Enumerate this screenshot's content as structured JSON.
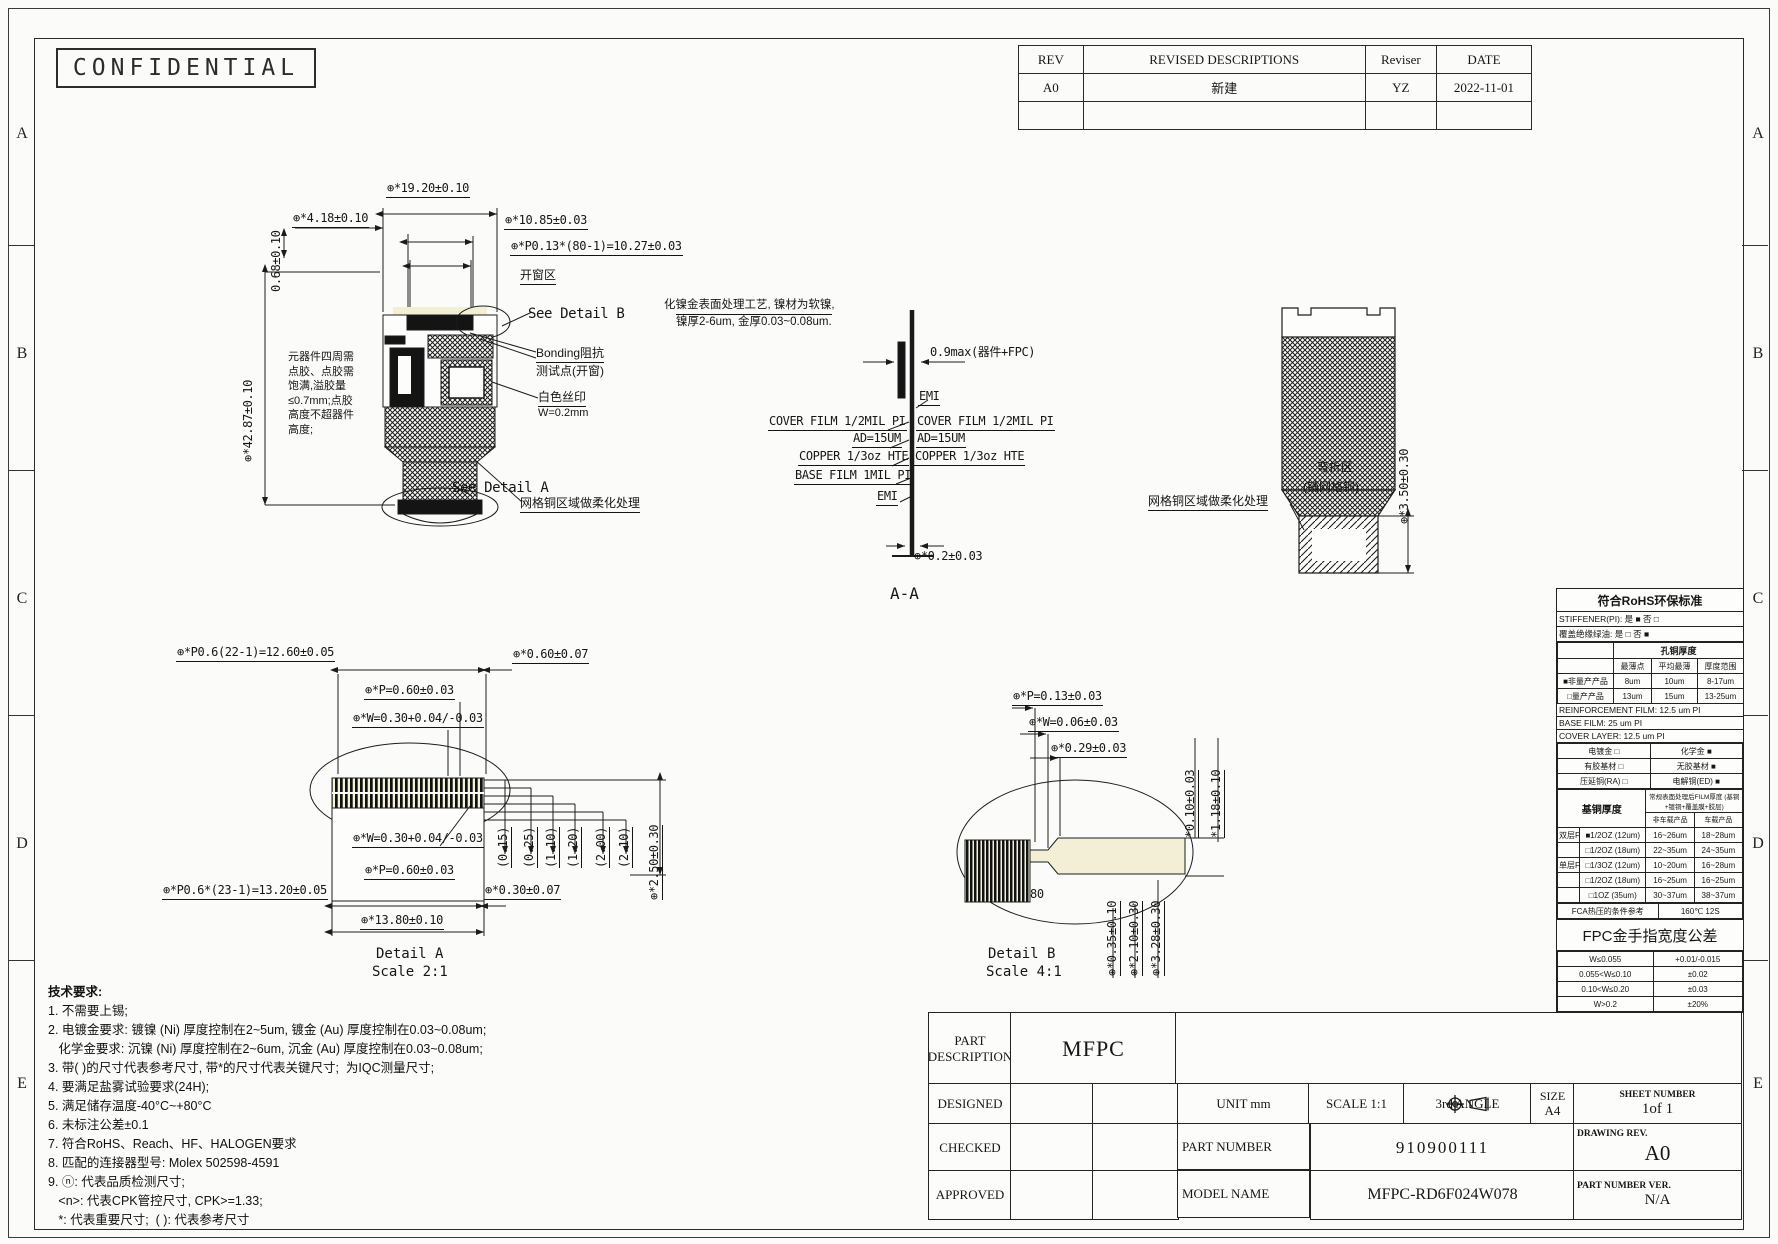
{
  "sheet": {
    "stamp": "CONFIDENTIAL",
    "zones": [
      "A",
      "B",
      "C",
      "D",
      "E"
    ]
  },
  "revision_table": {
    "headers": [
      "REV",
      "REVISED DESCRIPTIONS",
      "Reviser",
      "DATE"
    ],
    "row": [
      "A0",
      "新建",
      "YZ",
      "2022-11-01"
    ]
  },
  "plan_view": {
    "dims": {
      "width": "⊕*19.20±0.10",
      "offset": "⊕*4.18±0.10",
      "edge": "0.68±0.10",
      "finger": "⊕*10.85±0.03",
      "pitch": "⊕*P0.13*(80-1)=10.27±0.03",
      "length": "⊕*42.87±0.10"
    },
    "labels": {
      "window": "开窗区",
      "see_detail_b": "See Detail B",
      "bonding1": "Bonding阻抗",
      "bonding2": "测试点(开窗)",
      "silk1": "白色丝印",
      "silk2": "W=0.2mm",
      "mesh": "网格铜区域做柔化处理",
      "see_detail_a": "See Detail A"
    },
    "glue_note": [
      "元器件四周需",
      "点胶、点胶需",
      "饱满,溢胶量",
      "≤0.7mm;点胶",
      "高度不超器件",
      "高度;"
    ]
  },
  "section_view": {
    "caption": "A-A",
    "note1": "化镍金表面处理工艺, 镍材为软镍,",
    "note2": "镍厚2-6um, 金厚0.03~0.08um.",
    "dim_max": "0.9max(器件+FPC)",
    "dim_thickness": "⊕*0.2±0.03",
    "layers": {
      "emi_r": "EMI",
      "cover_l": "COVER FILM 1/2MIL PI",
      "cover_r": "COVER FILM 1/2MIL PI",
      "ad_l": "AD=15UM",
      "ad_r": "AD=15UM",
      "cu_l": "COPPER 1/3oz HTE",
      "cu_r": "COPPER 1/3oz HTE",
      "base_l": "BASE FILM 1MIL PI",
      "emi_l": "EMI"
    }
  },
  "bend_view": {
    "mesh": "网格铜区域做柔化处理",
    "zone1": "弯折区",
    "zone2": "(铺网格铜)",
    "dim": "⊕*3.50±0.30"
  },
  "detail_a": {
    "caption": "Detail A",
    "scale": "Scale 2:1",
    "dims": {
      "pitch_total_top": "⊕*P0.6(22-1)=12.60±0.05",
      "end_width": "⊕*0.60±0.07",
      "pitch_top": "⊕*P=0.60±0.03",
      "width_top": "⊕*W=0.30+0.04/-0.03",
      "width_in": "⊕*W=0.30+0.04/-0.03",
      "pitch_in": "⊕*P=0.60±0.03",
      "pitch_total_bottom": "⊕*P0.6*(23-1)=13.20±0.05",
      "pad_width": "⊕*0.30±0.07",
      "total_width": "⊕*13.80±0.10",
      "height": "⊕*2.50±0.30"
    },
    "step_dims": [
      "(0.15)",
      "(0.25)",
      "(1.10)",
      "(1.20)",
      "(2.00)",
      "(2.10)"
    ]
  },
  "detail_b": {
    "caption": "Detail B",
    "scale": "Scale 4:1",
    "count": "80",
    "dims": {
      "pitch": "⊕*P=0.13±0.03",
      "width": "⊕*W=0.06±0.03",
      "offset": "⊕*0.29±0.03",
      "gap": "*0.10±0.03",
      "height": "*1.18±0.10",
      "b1": "⊕*0.35±0.10",
      "b2": "⊕*2.10±0.30",
      "b3": "⊕*3.28±0.30"
    }
  },
  "tech_notes": {
    "title": "技术要求:",
    "lines": [
      "1. 不需要上锡;",
      "2. 电镀金要求: 镀镍 (Ni) 厚度控制在2~5um, 镀金 (Au) 厚度控制在0.03~0.08um;",
      "   化学金要求: 沉镍 (Ni) 厚度控制在2~6um, 沉金 (Au) 厚度控制在0.03~0.08um;",
      "3. 带( )的尺寸代表参考尺寸, 带*的尺寸代表关键尺寸;  为IQC测量尺寸;",
      "4. 要满足盐雾试验要求(24H);",
      "5. 满足储存温度-40°C~+80°C",
      "6. 未标注公差±0.1",
      "7. 符合RoHS、Reach、HF、HALOGEN要求",
      "8. 匹配的连接器型号: Molex 502598-4591",
      "9. ⓝ: 代表品质检测尺寸;",
      "   <n>: 代表CPK管控尺寸, CPK>=1.33;",
      "   *: 代表重要尺寸;  ( ): 代表参考尺寸"
    ]
  },
  "spec_table": {
    "rohs_title": "符合RoHS环保标准",
    "option_lines": [
      "STIFFENER(PI):  是 ■   否 □",
      "覆盖绝缘绿油:  是 □   否 ■"
    ],
    "hole_copper": {
      "title": "孔铜厚度",
      "headers": [
        "",
        "最薄点",
        "平均最薄",
        "厚度范围"
      ],
      "rows": [
        [
          "■非量产产品",
          "8um",
          "10um",
          "8-17um"
        ],
        [
          "□量产产品",
          "13um",
          "15um",
          "13-25um"
        ]
      ]
    },
    "film_lines": [
      "REINFORCEMENT FILM: 12.5 um PI",
      "BASE FILM:  25  um PI",
      "COVER LAYER:  12.5 um PI"
    ],
    "material_rows": [
      [
        "电镀金 □",
        "化学金 ■"
      ],
      [
        "有胶基材 □",
        "无胶基材 ■"
      ],
      [
        "压延铜(RA) □",
        "电解铜(ED) ■"
      ]
    ],
    "base_copper": {
      "h1": "基铜厚度",
      "h2": "常规表面处理后FILM厚度 (基铜+镀铜+覆盖膜+胶层)",
      "sub": [
        "非车载产品",
        "车载产品"
      ],
      "rows": [
        [
          "双层FPC",
          "■1/2OZ (12um)",
          "16~26um",
          "18~28um"
        ],
        [
          "",
          "□1/2OZ (18um)",
          "22~35um",
          "24~35um"
        ],
        [
          "单层FPC",
          "□1/3OZ (12um)",
          "10~20um",
          "16~28um"
        ],
        [
          "",
          "□1/2OZ (18um)",
          "16~25um",
          "16~25um"
        ],
        [
          "",
          "□1OZ (35um)",
          "30~37um",
          "38~37um"
        ]
      ]
    },
    "fca_row": [
      "FCA热压的条件参考",
      "160℃ 12S"
    ],
    "finger_title": "FPC金手指宽度公差",
    "finger_rows": [
      [
        "W≤0.055",
        "+0.01/-0.015"
      ],
      [
        "0.055<W≤0.10",
        "±0.02"
      ],
      [
        "0.10<W≤0.20",
        "±0.03"
      ],
      [
        "W>0.2",
        "±20%"
      ]
    ]
  },
  "title_block": {
    "part_description_label": "PART DESCRIPTION",
    "part_description": "MFPC",
    "designed": "DESIGNED",
    "checked": "CHECKED",
    "approved": "APPROVED",
    "unit_label": "UNIT  mm",
    "scale_label": "SCALE  1:1",
    "angle_label": "3rd ANGLE",
    "size_label": "SIZE",
    "size": "A4",
    "sheet_label": "SHEET NUMBER",
    "sheet": "1of 1",
    "part_number_label": "PART NUMBER",
    "part_number": "910900111",
    "drawing_rev_label": "DRAWING REV.",
    "drawing_rev": "A0",
    "model_name_label": "MODEL NAME",
    "model_name": "MFPC-RD6F024W078",
    "part_number_ver_label": "PART NUMBER VER.",
    "part_number_ver": "N/A"
  }
}
